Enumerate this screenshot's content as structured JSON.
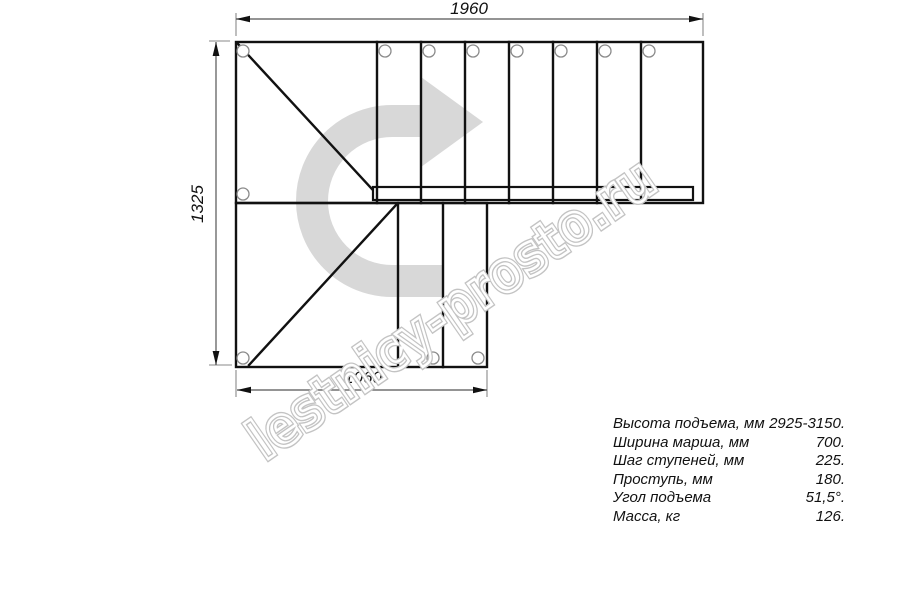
{
  "drawing": {
    "title": "stair-plan-top-view",
    "dimensions": {
      "top": "1960",
      "left": "1325",
      "bottom": "1060"
    },
    "watermark": "lestnicy-prosto.ru",
    "colors": {
      "line": "#111111",
      "dimension_line": "#8a8a8a",
      "arrow_gray": "#d8d8d8",
      "watermark_gray": "#c3c3c3",
      "hole_stroke": "#8a8a8a"
    }
  },
  "specs": {
    "rows": [
      {
        "label": "Высота подъема, мм",
        "value": "2925-3150."
      },
      {
        "label": "Ширина марша, мм",
        "value": "700."
      },
      {
        "label": "Шаг ступеней, мм",
        "value": "225."
      },
      {
        "label": "Проступь, мм",
        "value": "180."
      },
      {
        "label": "Угол подъема",
        "value": "51,5°."
      },
      {
        "label": "Масса, кг",
        "value": "126."
      }
    ]
  }
}
